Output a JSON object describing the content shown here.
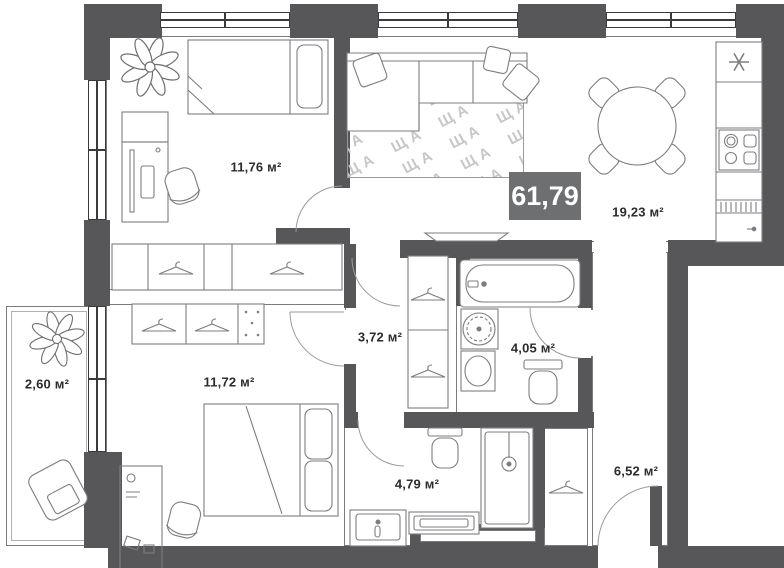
{
  "floor_plan": {
    "total_area_badge": "61,79",
    "rooms": [
      {
        "name": "bedroom-1",
        "area": "11,76 м²"
      },
      {
        "name": "living-kitchen",
        "area": "19,23 м²"
      },
      {
        "name": "hallway",
        "area": "3,72 м²"
      },
      {
        "name": "bathroom",
        "area": "4,05 м²"
      },
      {
        "name": "bedroom-2",
        "area": "11,72 м²"
      },
      {
        "name": "balcony",
        "area": "2,60 м²"
      },
      {
        "name": "shower-room",
        "area": "4,79 м²"
      },
      {
        "name": "entry-hall",
        "area": "6,52 м²"
      }
    ],
    "rug_pattern_text": "ЩА",
    "colors": {
      "wall": "#57575a",
      "badge_bg": "#6e6f71",
      "badge_text": "#ffffff",
      "label_text": "#2c2c2e",
      "furniture_line": "#7d7d80"
    }
  }
}
